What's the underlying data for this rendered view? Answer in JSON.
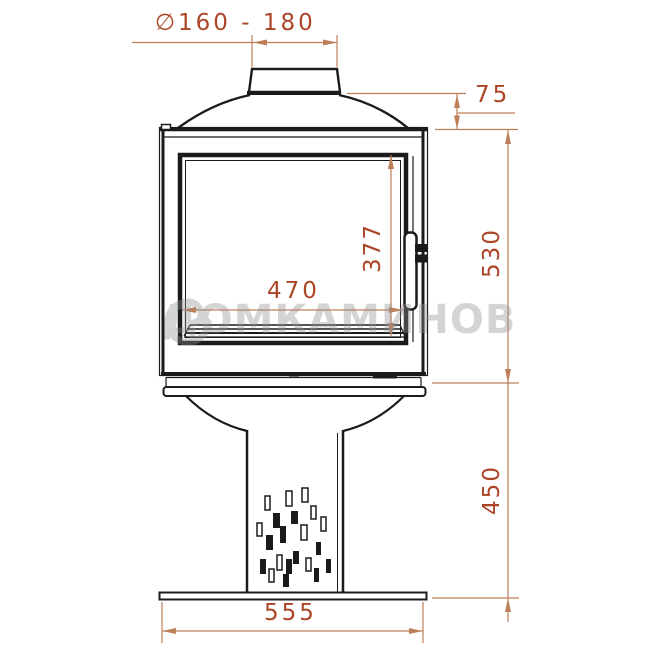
{
  "drawing": {
    "watermark": "ДОМКАМИНОВ",
    "labels": {
      "flue_diameter": "∅160 - 180",
      "dome_height": "75",
      "firebox_height": "530",
      "pedestal_height": "450",
      "glass_width": "470",
      "glass_height": "377",
      "base_width": "555"
    },
    "colors": {
      "outline": "#1b1b1b",
      "dim_line": "#bd7f58",
      "dim_text": "#ac4526",
      "watermark": "#8f8f8f"
    }
  }
}
